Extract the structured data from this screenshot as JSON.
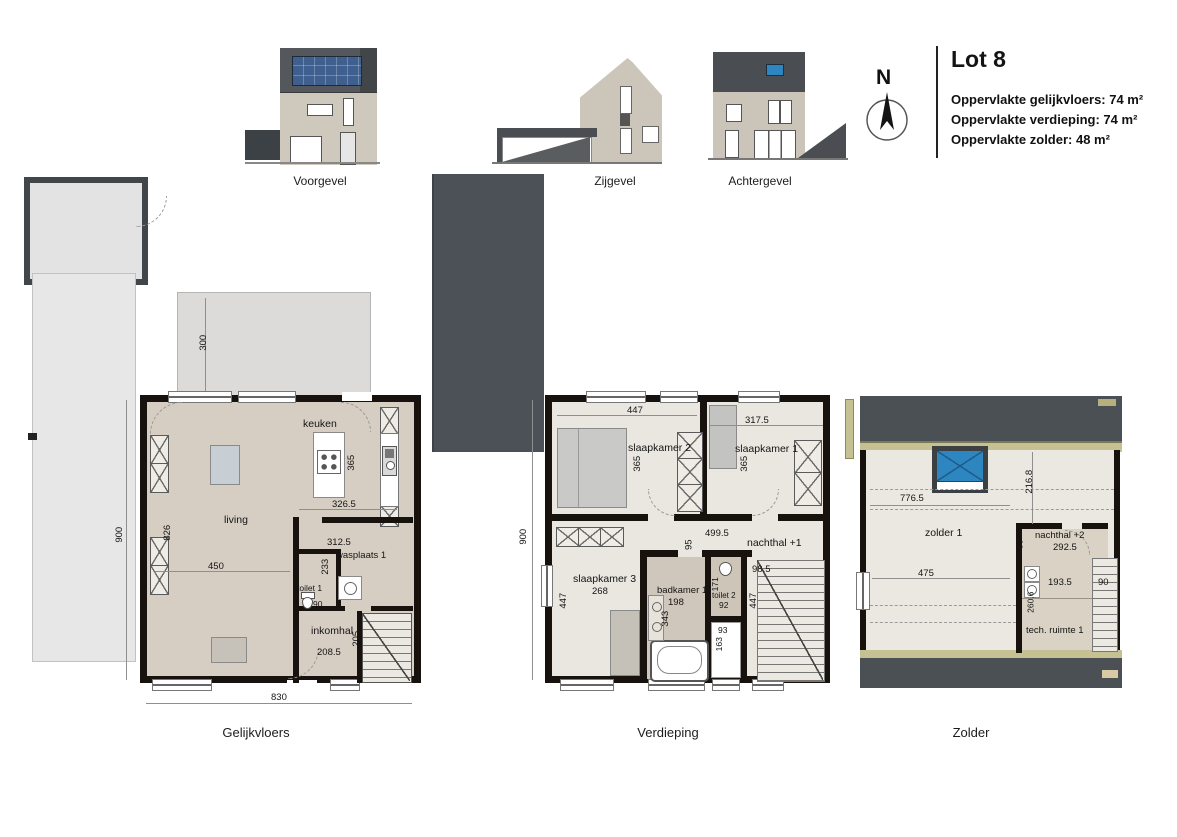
{
  "header": {
    "title": "Lot 8",
    "north_label": "N",
    "area_lines": [
      "Oppervlakte gelijkvloers: 74 m²",
      "Oppervlakte verdieping: 74 m²",
      "Oppervlakte zolder: 48 m²"
    ]
  },
  "elevations": {
    "voorgevel_label": "Voorgevel",
    "zijgevel_label": "Zijgevel",
    "achtergevel_label": "Achtergevel"
  },
  "site": {
    "terrace_depth": "300"
  },
  "gelijkvloers": {
    "label": "Gelijkvloers",
    "rooms": {
      "living": "living",
      "keuken": "keuken",
      "wasplaats": "wasplaats 1",
      "toilet": "toilet 1",
      "inkomhal": "inkomhal"
    },
    "dims": {
      "total_w": "830",
      "total_h": "900",
      "living_w": "450",
      "living_h": "826",
      "keuken_h": "365",
      "keuken_w": "326.5",
      "wasplaats_w": "312.5",
      "wasplaats_h": "233",
      "toilet_w": "90",
      "inkomhal_w": "208.5",
      "inkomhal_h": "205"
    }
  },
  "verdieping": {
    "label": "Verdieping",
    "rooms": {
      "slaapkamer2": "slaapkamer 2",
      "slaapkamer1": "slaapkamer 1",
      "slaapkamer3": "slaapkamer 3",
      "badkamer": "badkamer 1",
      "toilet": "toilet 2",
      "nachthal": "nachthal +1"
    },
    "dims": {
      "total_h": "900",
      "sk2_w": "447",
      "sk1_w": "317.5",
      "sk2_h": "365",
      "sk1_h": "365",
      "hal_w": "499.5",
      "hal_d": "95",
      "nachthal_d": "98.5",
      "nachthal_h": "447",
      "sk3_w": "268",
      "sk3_h": "447",
      "badkamer_w": "198",
      "badkamer_h": "343",
      "toilet_w": "92",
      "toilet_h": "171",
      "douche_w": "93",
      "douche_h": "163"
    }
  },
  "zolder": {
    "label": "Zolder",
    "rooms": {
      "zolder": "zolder 1",
      "nachthal": "nachthal +2",
      "tech": "tech. ruimte 1"
    },
    "dims": {
      "zolder_w": "776.5",
      "roof_d": "216.8",
      "nachthal_w": "292.5",
      "nachthal_h": "90",
      "floor_w": "475",
      "tech_w": "193.5",
      "tech_h": "260.6",
      "stairs_w": "90"
    }
  },
  "colors": {
    "wall": "#17120e",
    "floor_beige": "#d6cec3",
    "floor_light": "#eae7e1",
    "roof_dark": "#4b5054",
    "olive": "#c6c192",
    "skylight_blue": "#2e86c1",
    "neighbor_gray": "#4b5157",
    "site_gray": "#e4e4e4"
  }
}
